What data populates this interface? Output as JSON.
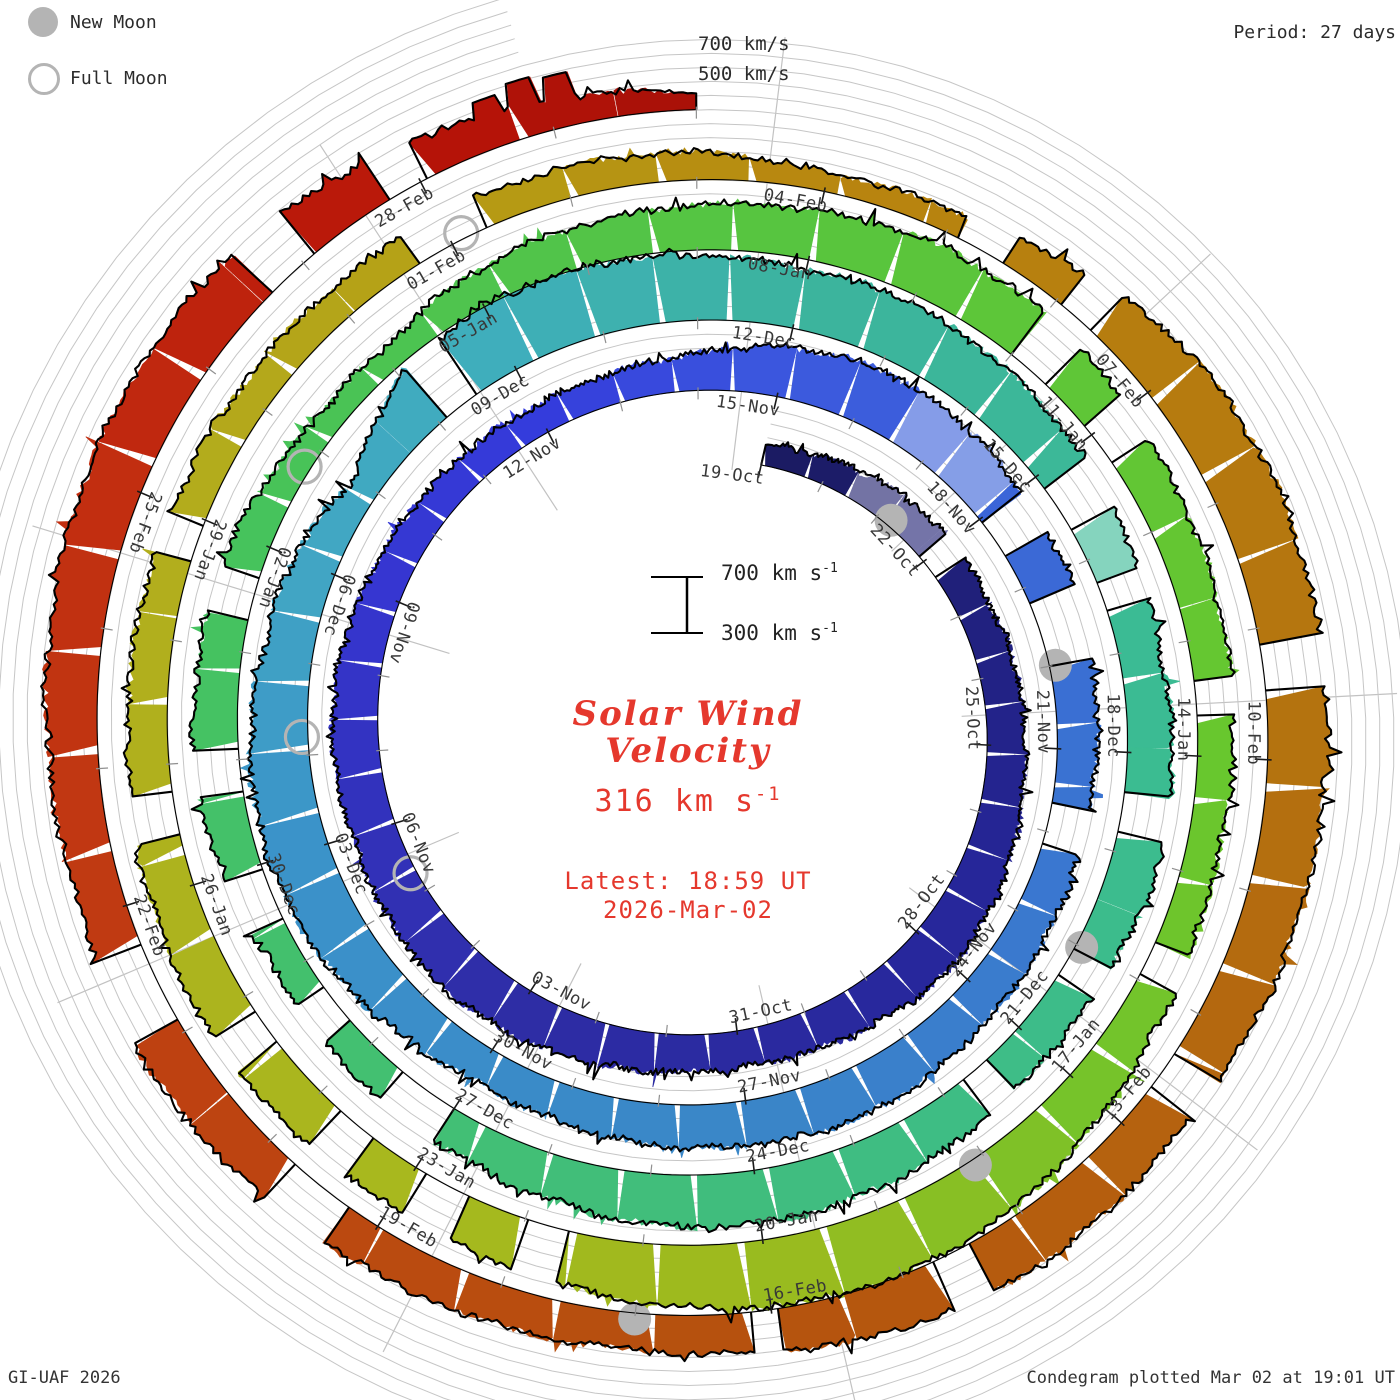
{
  "legend": {
    "new_moon": "New Moon",
    "full_moon": "Full Moon"
  },
  "header": {
    "period": "Period: 27 days"
  },
  "axis_top": {
    "l700": "700 km/s",
    "l500": "500 km/s"
  },
  "center": {
    "scale_top_main": "700 km s",
    "scale_top_exp": "-1",
    "scale_bottom_main": "300 km s",
    "scale_bottom_exp": "-1",
    "title_line1": "Solar Wind",
    "title_line2": "Velocity",
    "value_main": "316 km s",
    "value_exp": "-1",
    "latest_line1": "Latest: 18:59 UT",
    "latest_line2": "2026-Mar-02"
  },
  "footer": {
    "left": "GI-UAF 2026",
    "right": "Condegram plotted Mar 02 at 19:01 UT"
  },
  "chart_data": {
    "type": "area",
    "variant": "condegram-spiral",
    "title": "Solar Wind Velocity",
    "units": "km/s",
    "period_days": 27,
    "start_date_label": "19-Oct",
    "end_date_label": "02-Mar",
    "latest": {
      "velocity_kms": 316,
      "time": "18:59 UT",
      "date": "2026-Mar-02"
    },
    "velocity_axis": {
      "base": 200,
      "gridlines": [
        300,
        400,
        500,
        600,
        700
      ]
    },
    "daily_velocity": [
      350,
      390,
      430,
      450,
      440,
      460,
      470,
      500,
      540,
      560,
      520,
      480,
      460,
      470,
      500,
      540,
      560,
      540,
      515,
      530,
      510,
      470,
      440,
      420,
      410,
      420,
      460,
      560,
      620,
      600,
      560,
      540,
      500,
      480,
      470,
      480,
      500,
      530,
      550,
      520,
      500,
      470,
      450,
      520,
      600,
      640,
      620,
      560,
      520,
      400,
      640,
      720,
      700,
      660,
      630,
      640,
      600,
      560,
      520,
      500,
      520,
      540,
      500,
      480,
      520,
      560,
      590,
      560,
      510,
      470,
      440,
      420,
      480,
      520,
      500,
      470,
      380,
      360,
      450,
      500,
      520,
      560,
      600,
      580,
      520,
      490,
      470,
      450,
      430,
      480,
      550,
      650,
      700,
      680,
      620,
      560,
      520,
      540,
      560,
      520,
      490,
      470,
      455,
      440,
      430,
      425,
      420,
      400,
      330,
      360,
      480,
      620,
      650,
      640,
      620,
      600,
      580,
      560,
      590,
      570,
      500,
      460,
      480,
      500,
      530,
      560,
      520,
      550,
      580,
      610,
      620,
      580,
      500,
      420,
      316
    ],
    "spikes": [
      [
        132.6,
        560
      ],
      [
        132.85,
        610
      ],
      [
        133.1,
        580
      ]
    ],
    "gaps": [
      [
        3.1,
        0.4
      ],
      [
        30.3,
        0.5
      ],
      [
        31.6,
        0.8
      ],
      [
        33.9,
        0.5
      ],
      [
        50.3,
        0.4
      ],
      [
        57.4,
        0.5
      ],
      [
        58.4,
        0.3
      ],
      [
        60.6,
        0.4
      ],
      [
        62.2,
        0.3
      ],
      [
        63.6,
        0.3
      ],
      [
        69.3,
        0.6
      ],
      [
        70.5,
        0.4
      ],
      [
        71.7,
        0.5
      ],
      [
        72.9,
        0.4
      ],
      [
        74.5,
        0.4
      ],
      [
        83.2,
        0.4
      ],
      [
        84.1,
        0.4
      ],
      [
        86.5,
        0.3
      ],
      [
        88.8,
        0.3
      ],
      [
        94.8,
        0.35
      ],
      [
        95.7,
        0.4
      ],
      [
        96.6,
        0.35
      ],
      [
        97.7,
        0.3
      ],
      [
        99.6,
        0.35
      ],
      [
        101.8,
        0.3
      ],
      [
        105.0,
        0.6
      ],
      [
        109.3,
        0.4
      ],
      [
        110.2,
        0.3
      ],
      [
        113.3,
        0.35
      ],
      [
        116.5,
        0.3
      ],
      [
        118.6,
        0.3
      ],
      [
        120.05,
        0.2
      ],
      [
        123.5,
        0.5
      ],
      [
        125.4,
        0.6
      ],
      [
        130.9,
        0.4
      ],
      [
        131.9,
        0.3
      ]
    ],
    "light_segments": [
      [
        1.5,
        3.1
      ],
      [
        28.4,
        29.6
      ],
      [
        57.6,
        58.8
      ]
    ],
    "date_labels": [
      {
        "day": 0,
        "label": "19-Oct"
      },
      {
        "day": 3,
        "label": "22-Oct"
      },
      {
        "day": 6,
        "label": "25-Oct"
      },
      {
        "day": 9,
        "label": "28-Oct"
      },
      {
        "day": 12,
        "label": "31-Oct"
      },
      {
        "day": 15,
        "label": "03-Nov"
      },
      {
        "day": 18,
        "label": "06-Nov"
      },
      {
        "day": 21,
        "label": "09-Nov"
      },
      {
        "day": 24,
        "label": "12-Nov"
      },
      {
        "day": 27,
        "label": "15-Nov"
      },
      {
        "day": 30,
        "label": "18-Nov"
      },
      {
        "day": 33,
        "label": "21-Nov"
      },
      {
        "day": 36,
        "label": "24-Nov"
      },
      {
        "day": 39,
        "label": "27-Nov"
      },
      {
        "day": 42,
        "label": "30-Nov"
      },
      {
        "day": 45,
        "label": "03-Dec"
      },
      {
        "day": 48,
        "label": "06-Dec"
      },
      {
        "day": 51,
        "label": "09-Dec"
      },
      {
        "day": 54,
        "label": "12-Dec"
      },
      {
        "day": 57,
        "label": "15-Dec"
      },
      {
        "day": 60,
        "label": "18-Dec"
      },
      {
        "day": 63,
        "label": "21-Dec"
      },
      {
        "day": 66,
        "label": "24-Dec"
      },
      {
        "day": 69,
        "label": "27-Dec"
      },
      {
        "day": 72,
        "label": "30-Dec"
      },
      {
        "day": 75,
        "label": "02-Jan"
      },
      {
        "day": 78,
        "label": "05-Jan"
      },
      {
        "day": 81,
        "label": "08-Jan"
      },
      {
        "day": 84,
        "label": "11-Jan"
      },
      {
        "day": 87,
        "label": "14-Jan"
      },
      {
        "day": 90,
        "label": "17-Jan"
      },
      {
        "day": 93,
        "label": "20-Jan"
      },
      {
        "day": 96,
        "label": "23-Jan"
      },
      {
        "day": 99,
        "label": "26-Jan"
      },
      {
        "day": 102,
        "label": "29-Jan"
      },
      {
        "day": 105,
        "label": "01-Feb"
      },
      {
        "day": 108,
        "label": "04-Feb"
      },
      {
        "day": 111,
        "label": "07-Feb"
      },
      {
        "day": 114,
        "label": "10-Feb"
      },
      {
        "day": 117,
        "label": "13-Feb"
      },
      {
        "day": 120,
        "label": "16-Feb"
      },
      {
        "day": 123,
        "label": "19-Feb"
      },
      {
        "day": 126,
        "label": "22-Feb"
      },
      {
        "day": 129,
        "label": "25-Feb"
      },
      {
        "day": 132,
        "label": "28-Feb"
      }
    ],
    "moons": {
      "new_days": [
        2.2,
        32.0,
        62.0,
        91.1,
        121.0
      ],
      "full_days": [
        17.3,
        46.2,
        75.8,
        105.1
      ]
    },
    "colormap": [
      [
        0,
        "#1b1b60"
      ],
      [
        8,
        "#26269a"
      ],
      [
        15,
        "#2e2da5"
      ],
      [
        21,
        "#3636d0"
      ],
      [
        24,
        "#343cdc"
      ],
      [
        27,
        "#3c58de"
      ],
      [
        33,
        "#3a72d2"
      ],
      [
        39,
        "#3a86c8"
      ],
      [
        45,
        "#3b93c9"
      ],
      [
        48,
        "#41a6c4"
      ],
      [
        51,
        "#3faebc"
      ],
      [
        54,
        "#3cb49e"
      ],
      [
        60,
        "#3bbc92"
      ],
      [
        66,
        "#40bd7e"
      ],
      [
        72,
        "#44c16a"
      ],
      [
        75,
        "#46c35c"
      ],
      [
        81,
        "#58c53e"
      ],
      [
        87,
        "#68c72e"
      ],
      [
        90,
        "#76c32a"
      ],
      [
        93,
        "#9cba1e"
      ],
      [
        96,
        "#a8b81e"
      ],
      [
        102,
        "#b3ad1d"
      ],
      [
        105,
        "#b59f16"
      ],
      [
        108,
        "#b8860f"
      ],
      [
        114,
        "#b4720f"
      ],
      [
        120,
        "#b5520e"
      ],
      [
        123,
        "#bb4a10"
      ],
      [
        126,
        "#c03a12"
      ],
      [
        129,
        "#c22d10"
      ],
      [
        132,
        "#b81408"
      ],
      [
        134,
        "#a81008"
      ]
    ],
    "layout": {
      "cx": 700,
      "cy": 730,
      "r0": 272,
      "px_per_day": 2.6,
      "phi0_deg": 13,
      "deg_per_day": 13.3333,
      "v_base": 200,
      "v_px_per_kms": 0.14,
      "grid_day_max": 160,
      "moon_radius": 16.5,
      "moon_base_offset": 6,
      "scale_bar": {
        "x": 687,
        "y_top": 577,
        "cap_half": 26
      }
    }
  }
}
